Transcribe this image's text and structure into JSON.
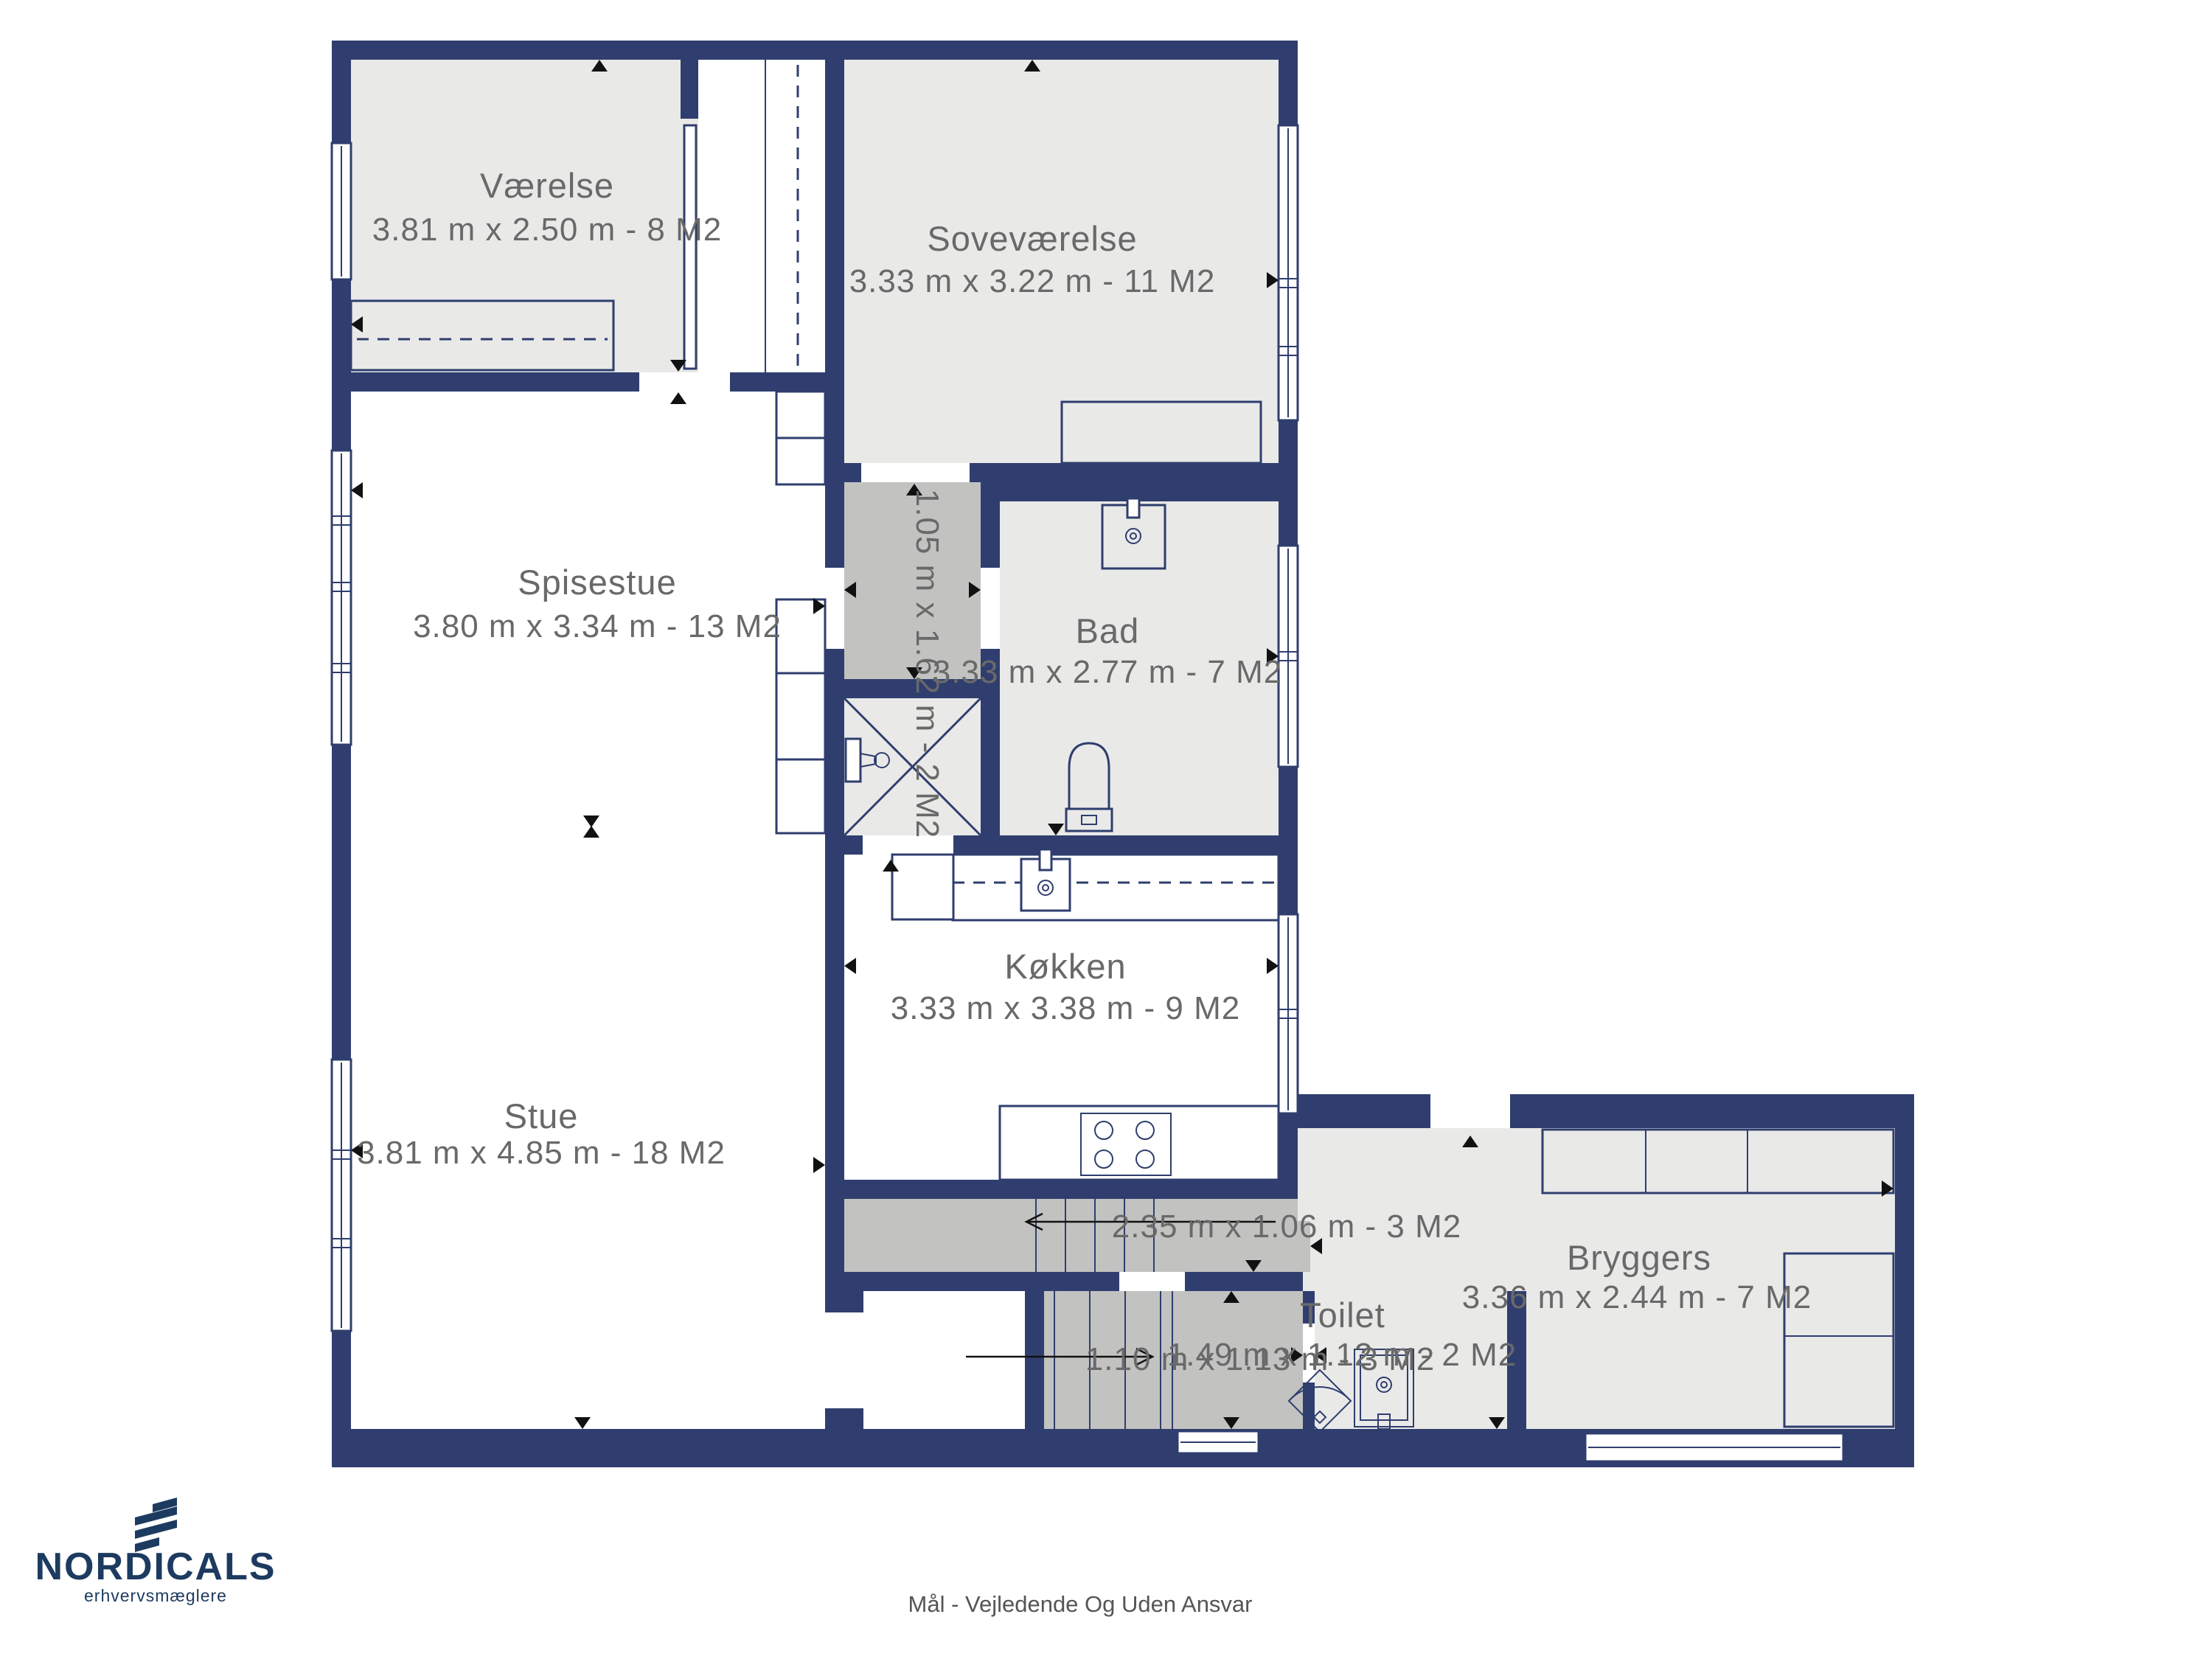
{
  "page": {
    "background": "#ffffff",
    "type": "floorplan"
  },
  "colors": {
    "wall": "#2f3e6e",
    "floor-light": "#e9e9e8",
    "floor-dark": "#c2c2c1",
    "floor-white": "#ffffff",
    "fixture-line": "#2f3e6e",
    "label-text": "#696969",
    "logo-navy": "#1d3b60",
    "arrow-black": "#111111",
    "disclaimer": "#555555"
  },
  "rooms": [
    {
      "id": "vaerelse",
      "name": "Værelse",
      "dims": "3.81 m x 2.50 m - 8 M2"
    },
    {
      "id": "sovevaerelse",
      "name": "Soveværelse",
      "dims": "3.33 m x 3.22 m - 11 M2"
    },
    {
      "id": "spisestue",
      "name": "Spisestue",
      "dims": "3.80 m x 3.34 m - 13 M2"
    },
    {
      "id": "stue",
      "name": "Stue",
      "dims": "3.81 m x 4.85 m - 18 M2"
    },
    {
      "id": "bad",
      "name": "Bad",
      "dims": "3.33 m x 2.77 m - 7 M2"
    },
    {
      "id": "gang",
      "name": "",
      "dims": "1.05 m x 1.62 m - 2 M2"
    },
    {
      "id": "koekken",
      "name": "Køkken",
      "dims": "3.33 m x 3.38 m - 9 M2"
    },
    {
      "id": "trappe-op",
      "name": "",
      "dims": "2.35 m x 1.06 m - 3 M2"
    },
    {
      "id": "entre",
      "name": "",
      "dims": "1.10 m x 1.13 m - 3 M2"
    },
    {
      "id": "toilet",
      "name": "Toilet",
      "dims": "1.49 m x 1.12 m - 2 M2"
    },
    {
      "id": "bryggers",
      "name": "Bryggers",
      "dims": "3.36 m x 2.44 m - 7 M2"
    }
  ],
  "icons": {
    "door-marker": "small black triangle at wall/door openings",
    "stair-direction": "thin arrow with open head along stair run",
    "bed": "rectangle with dashed centre line",
    "shower": "square with X diagonals",
    "toilet-fixture": "bowl with cistern",
    "washbasin": "square basin with tap"
  },
  "footer": {
    "brand": "NORDICALS",
    "tagline": "erhvervsmæglere",
    "disclaimer": "Mål - Vejledende Og Uden Ansvar"
  }
}
